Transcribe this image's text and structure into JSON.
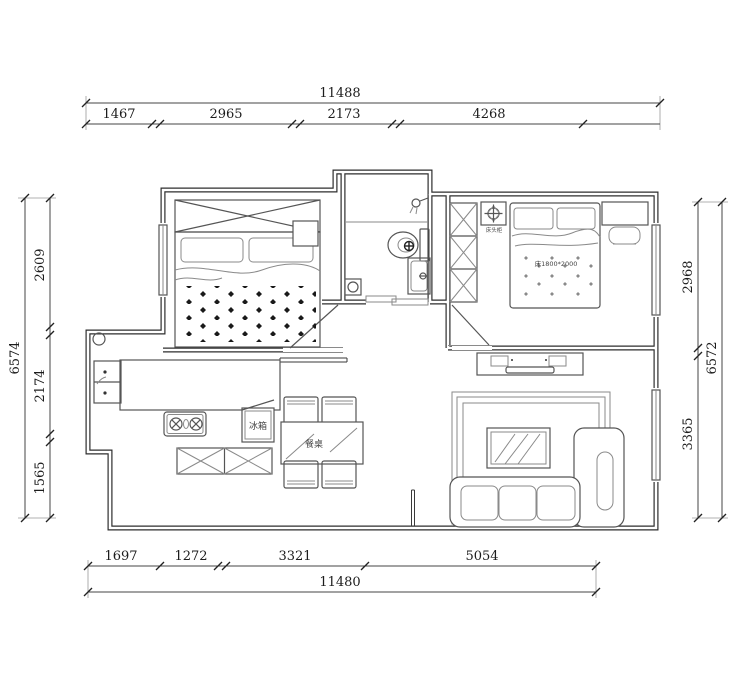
{
  "dims_top": {
    "overall": "11488",
    "seg1": "1467",
    "seg2": "2965",
    "seg3": "2173",
    "seg4": "4268"
  },
  "dims_bottom": {
    "overall": "11480",
    "seg1": "1697",
    "seg2": "1272",
    "seg3": "3321",
    "seg4": "5054"
  },
  "dims_left": {
    "overall": "6574",
    "seg1": "2609",
    "seg2": "2174",
    "seg3": "1565"
  },
  "dims_right": {
    "overall": "6572",
    "seg1": "2968",
    "seg2": "3365"
  },
  "labels": {
    "fridge": "冰箱",
    "dining_table": "餐桌",
    "bed_spec": "床1800*2000",
    "nightstand": "床头柜"
  },
  "colors": {
    "wall": "#2e2e2e",
    "furniture": "#555555",
    "dimension": "#1c1c1c",
    "background": "#ffffff"
  }
}
